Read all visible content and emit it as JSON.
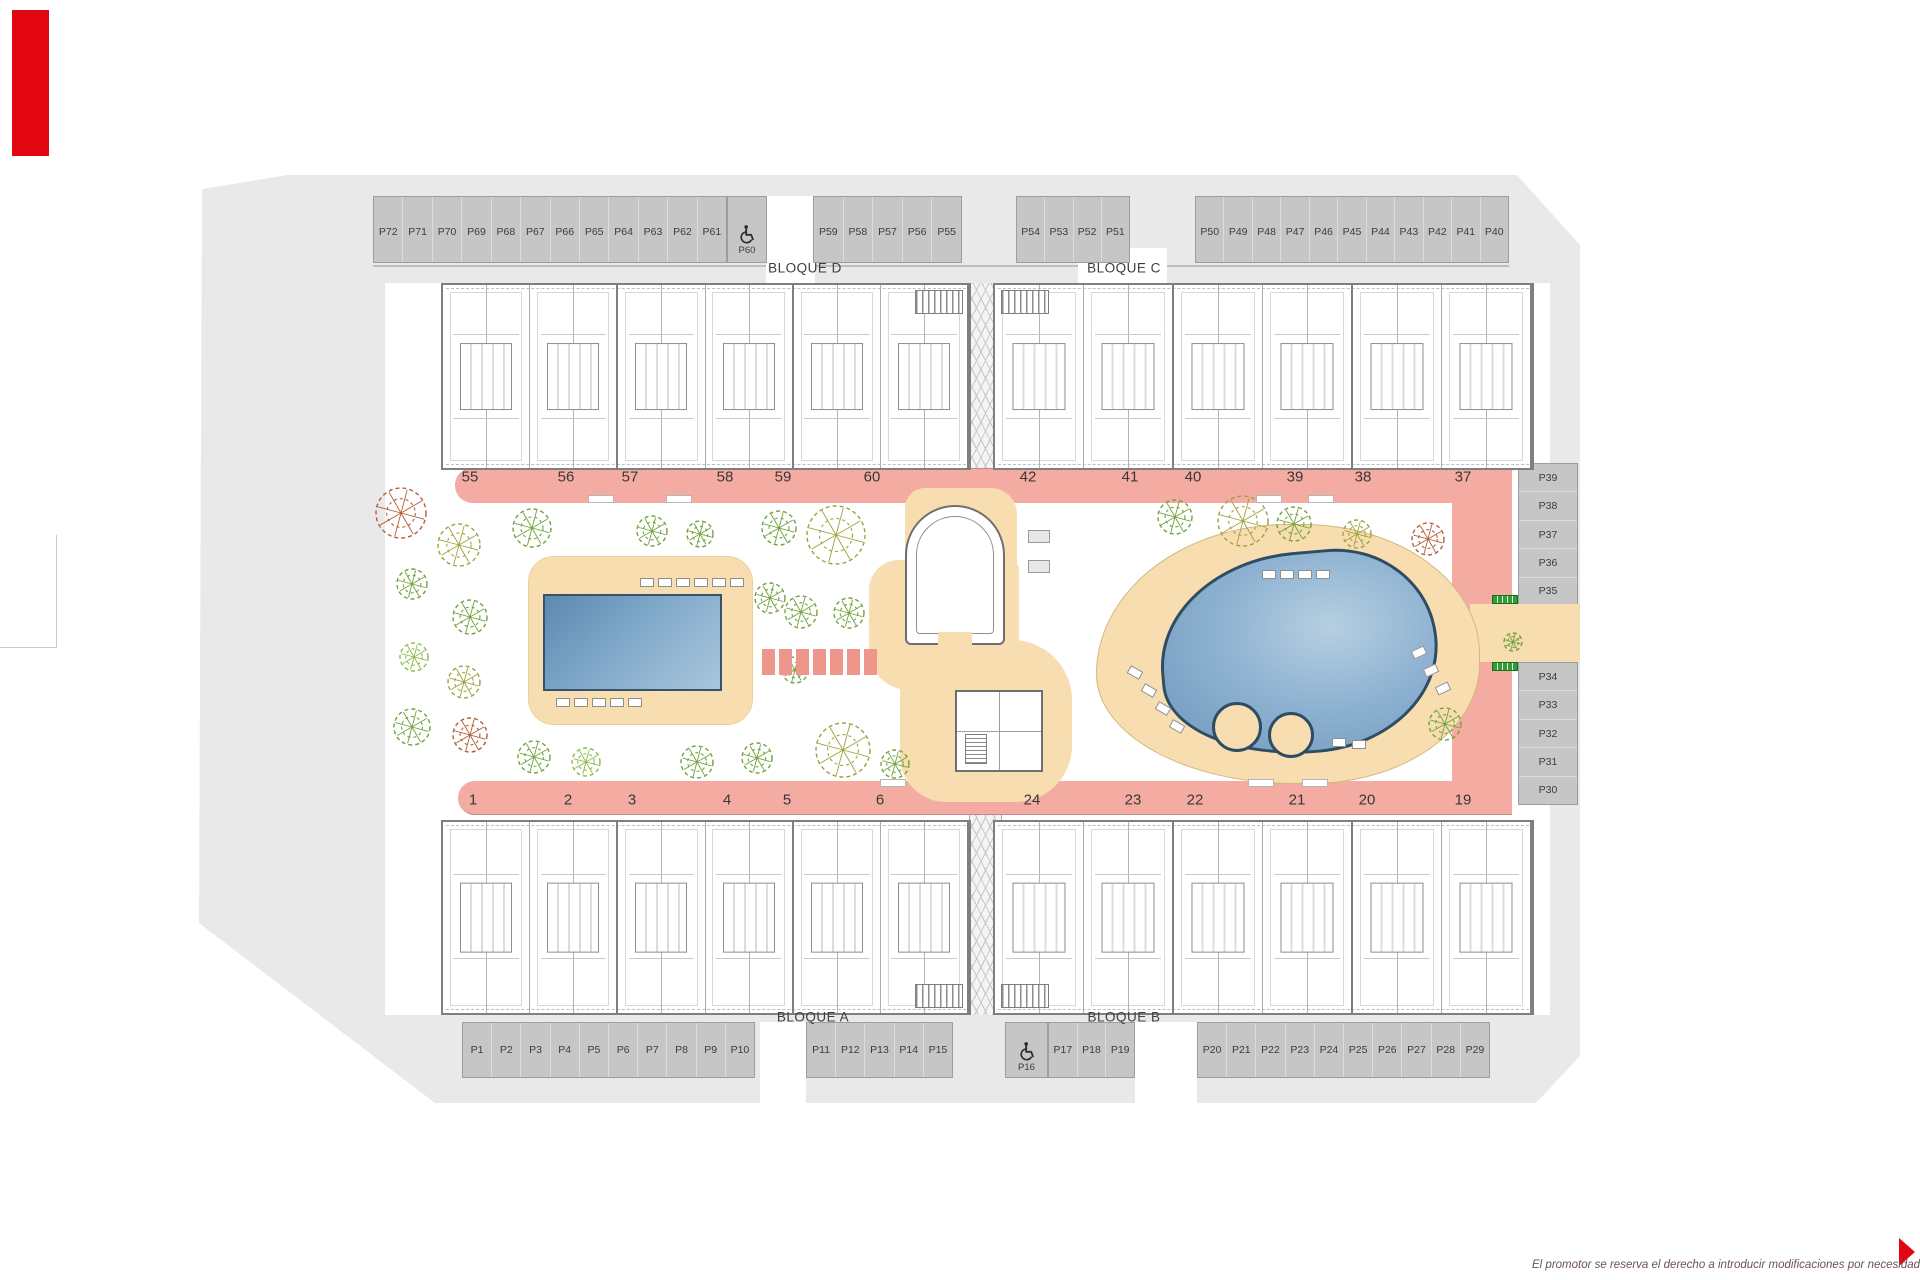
{
  "blocks": {
    "a": "BLOQUE A",
    "b": "BLOQUE B",
    "c": "BLOQUE C",
    "d": "BLOQUE D"
  },
  "parking": {
    "top_left": [
      "P72",
      "P71",
      "P70",
      "P69",
      "P68",
      "P67",
      "P66",
      "P65",
      "P64",
      "P63",
      "P62",
      "P61"
    ],
    "top_left_accessible": "P60",
    "top_mid_left": [
      "P59",
      "P58",
      "P57",
      "P56",
      "P55"
    ],
    "top_mid_right": [
      "P54",
      "P53",
      "P52",
      "P51"
    ],
    "top_right": [
      "P50",
      "P49",
      "P48",
      "P47",
      "P46",
      "P45",
      "P44",
      "P43",
      "P42",
      "P41",
      "P40"
    ],
    "right_upper": [
      "P39",
      "P38",
      "P37",
      "P36",
      "P35"
    ],
    "right_lower": [
      "P34",
      "P33",
      "P32",
      "P31",
      "P30"
    ],
    "bottom_left": [
      "P1",
      "P2",
      "P3",
      "P4",
      "P5",
      "P6",
      "P7",
      "P8",
      "P9",
      "P10"
    ],
    "bottom_mid": [
      "P11",
      "P12",
      "P13",
      "P14",
      "P15"
    ],
    "bottom_accessible": "P16",
    "bottom_mid_right": [
      "P17",
      "P18",
      "P19"
    ],
    "bottom_right": [
      "P20",
      "P21",
      "P22",
      "P23",
      "P24",
      "P25",
      "P26",
      "P27",
      "P28",
      "P29"
    ]
  },
  "units": {
    "top_left_row": [
      "55",
      "56",
      "57",
      "58",
      "59",
      "60"
    ],
    "top_right_row": [
      "42",
      "41",
      "40",
      "39",
      "38",
      "37"
    ],
    "bottom_left_row": [
      "1",
      "2",
      "3",
      "4",
      "5",
      "6"
    ],
    "bottom_right_row": [
      "24",
      "23",
      "22",
      "21",
      "20",
      "19"
    ]
  },
  "footer": {
    "disclaimer": "El promotor se reserva el derecho a introducir modificaciones por necesidad de índole técnica o legal"
  },
  "colors": {
    "accent_red": "#e30613",
    "walkway_pink": "#f3aba2",
    "deck_beige": "#f8ddb0",
    "pool_blue": "#7fa8c9",
    "parking_gray": "#c6c6c6",
    "tree_palette": [
      "#6fa33c",
      "#9ea23b",
      "#b05f38",
      "#8cbb4b"
    ]
  }
}
